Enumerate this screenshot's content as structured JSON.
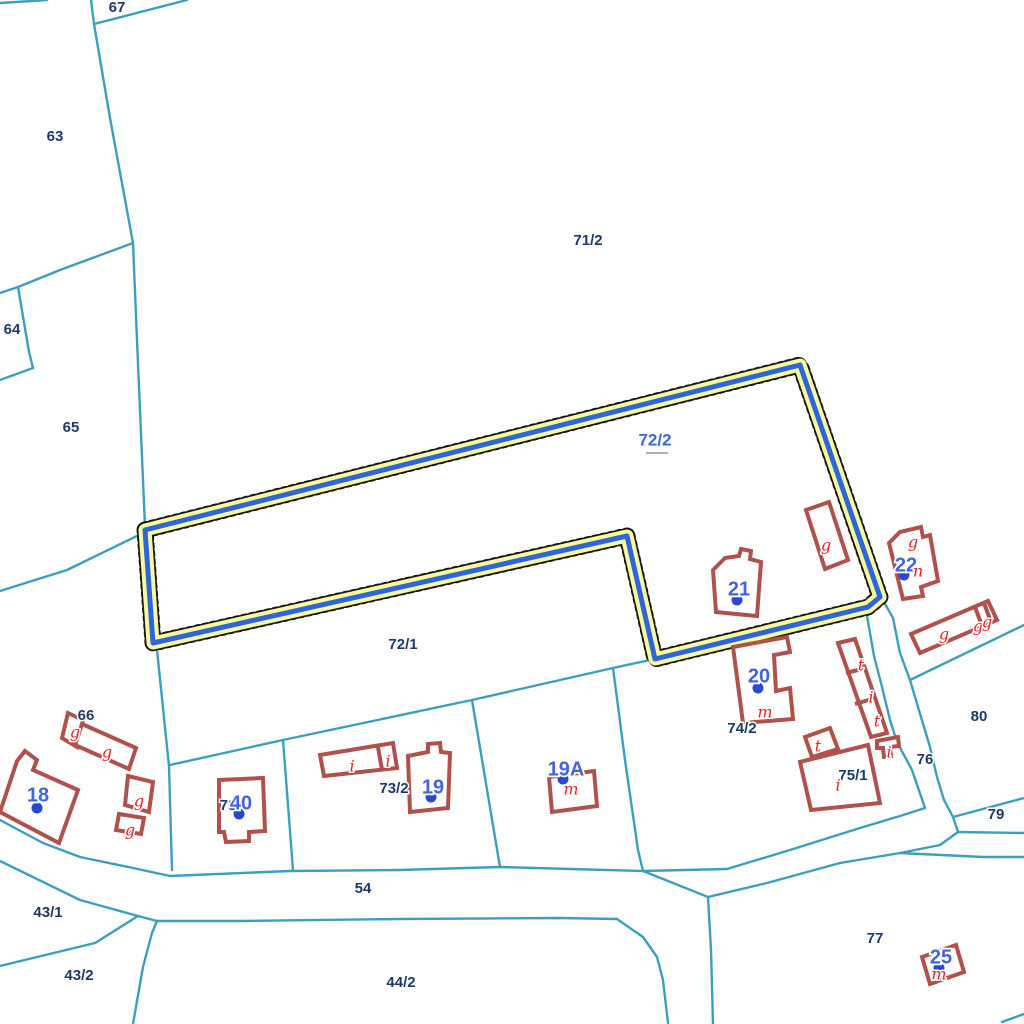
{
  "map": {
    "title": "cadastral-parcel-map",
    "selected_parcel": "72/2",
    "colors": {
      "boundary": "#3C9FC0",
      "parcel_label": "#1D3A6C",
      "selected_label": "#3B6AD9",
      "house_number": "#4463E4",
      "house_dot": "#2B49D0",
      "building_stroke": "#B0524B",
      "use_label": "#E4252B",
      "highlight_halo": "#F8F8A0",
      "highlight_stroke": "#2D65DB",
      "highlight_dots": "#161616",
      "background": "#FFFFFF"
    }
  },
  "boundaries": [
    {
      "points": [
        [
          0,
          3
        ],
        [
          47,
          0
        ]
      ]
    },
    {
      "points": [
        [
          91,
          0
        ],
        [
          94,
          24
        ],
        [
          110,
          118
        ],
        [
          133,
          243
        ],
        [
          137,
          340
        ],
        [
          145,
          527
        ]
      ]
    },
    {
      "points": [
        [
          94,
          24
        ],
        [
          187,
          0
        ]
      ]
    },
    {
      "points": [
        [
          133,
          243
        ],
        [
          60,
          270
        ],
        [
          18,
          287
        ],
        [
          0,
          293
        ]
      ]
    },
    {
      "points": [
        [
          18,
          287
        ],
        [
          29,
          352
        ],
        [
          33,
          368
        ]
      ]
    },
    {
      "points": [
        [
          33,
          368
        ],
        [
          0,
          380
        ]
      ]
    },
    {
      "points": [
        [
          0,
          591
        ],
        [
          67,
          570
        ],
        [
          143,
          533
        ]
      ]
    },
    {
      "points": [
        [
          145,
          529
        ],
        [
          157,
          650
        ],
        [
          169,
          766
        ],
        [
          172,
          870
        ]
      ]
    },
    {
      "points": [
        [
          170,
          765
        ],
        [
          283,
          740
        ],
        [
          472,
          700
        ],
        [
          613,
          668
        ],
        [
          650,
          660
        ]
      ]
    },
    {
      "points": [
        [
          283,
          740
        ],
        [
          293,
          870
        ]
      ]
    },
    {
      "points": [
        [
          472,
          700
        ],
        [
          500,
          867
        ]
      ]
    },
    {
      "points": [
        [
          613,
          668
        ],
        [
          625,
          760
        ],
        [
          638,
          850
        ],
        [
          643,
          871
        ]
      ]
    },
    {
      "points": [
        [
          0,
          820
        ],
        [
          43,
          843
        ],
        [
          80,
          857
        ],
        [
          133,
          868
        ],
        [
          170,
          876
        ],
        [
          290,
          871
        ],
        [
          400,
          870
        ],
        [
          500,
          867
        ],
        [
          570,
          869
        ],
        [
          643,
          871
        ],
        [
          727,
          869
        ]
      ]
    },
    {
      "points": [
        [
          727,
          869
        ],
        [
          790,
          850
        ],
        [
          860,
          828
        ],
        [
          900,
          816
        ],
        [
          925,
          808
        ]
      ]
    },
    {
      "points": [
        [
          866,
          610
        ],
        [
          874,
          656
        ],
        [
          882,
          687
        ],
        [
          890,
          720
        ],
        [
          897,
          742
        ],
        [
          912,
          770
        ],
        [
          925,
          808
        ]
      ]
    },
    {
      "points": [
        [
          884,
          602
        ],
        [
          893,
          618
        ],
        [
          900,
          653
        ],
        [
          910,
          680
        ],
        [
          918,
          707
        ],
        [
          930,
          747
        ],
        [
          937,
          777
        ],
        [
          944,
          800
        ],
        [
          953,
          817
        ]
      ]
    },
    {
      "points": [
        [
          910,
          680
        ],
        [
          1024,
          625
        ]
      ]
    },
    {
      "points": [
        [
          953,
          817
        ],
        [
          1024,
          798
        ]
      ]
    },
    {
      "points": [
        [
          953,
          817
        ],
        [
          958,
          832
        ],
        [
          1024,
          833
        ]
      ]
    },
    {
      "points": [
        [
          708,
          897
        ],
        [
          767,
          883
        ],
        [
          840,
          863
        ],
        [
          900,
          853
        ],
        [
          940,
          845
        ],
        [
          958,
          832
        ]
      ]
    },
    {
      "points": [
        [
          0,
          861
        ],
        [
          80,
          900
        ],
        [
          138,
          916
        ],
        [
          157,
          921
        ],
        [
          243,
          921
        ],
        [
          400,
          919
        ],
        [
          560,
          918
        ],
        [
          617,
          919
        ]
      ]
    },
    {
      "points": [
        [
          617,
          919
        ],
        [
          643,
          937
        ],
        [
          657,
          957
        ],
        [
          663,
          980
        ],
        [
          668,
          1023
        ]
      ]
    },
    {
      "points": [
        [
          643,
          871
        ],
        [
          708,
          897
        ]
      ]
    },
    {
      "points": [
        [
          708,
          897
        ],
        [
          711,
          950
        ],
        [
          713,
          1024
        ]
      ]
    },
    {
      "points": [
        [
          138,
          916
        ],
        [
          95,
          943
        ],
        [
          0,
          966
        ]
      ]
    },
    {
      "points": [
        [
          157,
          921
        ],
        [
          152,
          933
        ],
        [
          143,
          967
        ],
        [
          133,
          1024
        ]
      ]
    },
    {
      "points": [
        [
          900,
          853
        ],
        [
          983,
          857
        ],
        [
          1024,
          857
        ]
      ]
    },
    {
      "points": [
        [
          1002,
          1022
        ],
        [
          1024,
          1014
        ]
      ]
    }
  ],
  "highlight": {
    "parcel": "72/2",
    "points": [
      [
        145,
        530
      ],
      [
        800,
        365
      ],
      [
        880,
        597
      ],
      [
        868,
        607
      ],
      [
        655,
        659
      ],
      [
        627,
        536
      ],
      [
        153,
        643
      ]
    ],
    "label": {
      "text": "72/2",
      "x": 655,
      "y": 441
    },
    "underline": [
      [
        646,
        453
      ],
      [
        668,
        453
      ]
    ]
  },
  "buildings": [
    {
      "points": [
        [
          17,
          761
        ],
        [
          25,
          751
        ],
        [
          37,
          760
        ],
        [
          33,
          770
        ],
        [
          78,
          790
        ],
        [
          59,
          843
        ],
        [
          0,
          812
        ]
      ]
    },
    {
      "points": [
        [
          68,
          713
        ],
        [
          83,
          720
        ],
        [
          77,
          747
        ],
        [
          62,
          738
        ]
      ]
    },
    {
      "points": [
        [
          82,
          724
        ],
        [
          136,
          748
        ],
        [
          129,
          769
        ],
        [
          75,
          745
        ]
      ]
    },
    {
      "points": [
        [
          128,
          776
        ],
        [
          153,
          782
        ],
        [
          149,
          812
        ],
        [
          125,
          805
        ]
      ]
    },
    {
      "points": [
        [
          119,
          814
        ],
        [
          144,
          818
        ],
        [
          141,
          834
        ],
        [
          116,
          830
        ]
      ]
    },
    {
      "points": [
        [
          219,
          780
        ],
        [
          263,
          778
        ],
        [
          265,
          831
        ],
        [
          249,
          832
        ],
        [
          249,
          841
        ],
        [
          226,
          842
        ],
        [
          224,
          832
        ],
        [
          219,
          832
        ]
      ]
    },
    {
      "points": [
        [
          320,
          755
        ],
        [
          393,
          743
        ],
        [
          397,
          768
        ],
        [
          324,
          776
        ]
      ]
    },
    {
      "points": [
        [
          408,
          756
        ],
        [
          428,
          752
        ],
        [
          428,
          744
        ],
        [
          440,
          743
        ],
        [
          441,
          752
        ],
        [
          450,
          753
        ],
        [
          448,
          808
        ],
        [
          410,
          812
        ]
      ]
    },
    {
      "points": [
        [
          549,
          777
        ],
        [
          594,
          771
        ],
        [
          597,
          806
        ],
        [
          552,
          812
        ]
      ]
    },
    {
      "points": [
        [
          733,
          647
        ],
        [
          787,
          637
        ],
        [
          790,
          652
        ],
        [
          774,
          655
        ],
        [
          776,
          691
        ],
        [
          790,
          688
        ],
        [
          793,
          719
        ],
        [
          743,
          723
        ]
      ]
    },
    {
      "points": [
        [
          713,
          570
        ],
        [
          725,
          558
        ],
        [
          739,
          556
        ],
        [
          741,
          549
        ],
        [
          751,
          551
        ],
        [
          750,
          559
        ],
        [
          761,
          562
        ],
        [
          757,
          616
        ],
        [
          716,
          612
        ]
      ]
    },
    {
      "points": [
        [
          806,
          510
        ],
        [
          829,
          502
        ],
        [
          848,
          560
        ],
        [
          825,
          569
        ]
      ]
    },
    {
      "points": [
        [
          889,
          543
        ],
        [
          900,
          532
        ],
        [
          921,
          527
        ],
        [
          923,
          537
        ],
        [
          930,
          535
        ],
        [
          938,
          581
        ],
        [
          921,
          587
        ],
        [
          923,
          596
        ],
        [
          903,
          599
        ]
      ]
    },
    {
      "points": [
        [
          911,
          634
        ],
        [
          988,
          601
        ],
        [
          997,
          620
        ],
        [
          920,
          653
        ]
      ]
    },
    {
      "points": [
        [
          838,
          643
        ],
        [
          855,
          639
        ],
        [
          887,
          733
        ],
        [
          871,
          737
        ]
      ]
    },
    {
      "points": [
        [
          805,
          737
        ],
        [
          830,
          728
        ],
        [
          838,
          749
        ],
        [
          812,
          757
        ]
      ]
    },
    {
      "points": [
        [
          800,
          762
        ],
        [
          868,
          745
        ],
        [
          880,
          803
        ],
        [
          811,
          810
        ]
      ]
    },
    {
      "points": [
        [
          877,
          741
        ],
        [
          898,
          737
        ],
        [
          899,
          746
        ],
        [
          890,
          747
        ],
        [
          891,
          756
        ],
        [
          884,
          757
        ],
        [
          883,
          748
        ],
        [
          877,
          748
        ]
      ]
    },
    {
      "points": [
        [
          922,
          957
        ],
        [
          956,
          945
        ],
        [
          964,
          972
        ],
        [
          930,
          984
        ]
      ]
    }
  ],
  "building_dividers": [
    {
      "points": [
        [
          378,
          747
        ],
        [
          382,
          770
        ]
      ]
    },
    {
      "points": [
        [
          975,
          607
        ],
        [
          982,
          626
        ]
      ]
    },
    {
      "points": [
        [
          984,
          603
        ],
        [
          991,
          622
        ]
      ]
    },
    {
      "points": [
        [
          846,
          673
        ],
        [
          862,
          669
        ]
      ]
    },
    {
      "points": [
        [
          855,
          704
        ],
        [
          872,
          699
        ]
      ]
    }
  ],
  "parcel_labels": [
    {
      "text": "67",
      "x": 117,
      "y": 8
    },
    {
      "text": "63",
      "x": 55,
      "y": 137
    },
    {
      "text": "64",
      "x": 12,
      "y": 330
    },
    {
      "text": "65",
      "x": 71,
      "y": 428
    },
    {
      "text": "71/2",
      "x": 588,
      "y": 241
    },
    {
      "text": "72/1",
      "x": 403,
      "y": 645
    },
    {
      "text": "66",
      "x": 86,
      "y": 716
    },
    {
      "text": "73",
      "x": 228,
      "y": 806
    },
    {
      "text": "73/2",
      "x": 394,
      "y": 789
    },
    {
      "text": "74/2",
      "x": 742,
      "y": 729
    },
    {
      "text": "75/1",
      "x": 853,
      "y": 776
    },
    {
      "text": "76",
      "x": 925,
      "y": 760
    },
    {
      "text": "80",
      "x": 979,
      "y": 717
    },
    {
      "text": "79",
      "x": 996,
      "y": 815
    },
    {
      "text": "77",
      "x": 875,
      "y": 939
    },
    {
      "text": "54",
      "x": 363,
      "y": 889
    },
    {
      "text": "43/1",
      "x": 48,
      "y": 913
    },
    {
      "text": "43/2",
      "x": 79,
      "y": 976
    },
    {
      "text": "44/2",
      "x": 401,
      "y": 983
    }
  ],
  "house_numbers": [
    {
      "text": "18",
      "x": 38,
      "y": 796,
      "dot": [
        37,
        808
      ]
    },
    {
      "text": "40",
      "x": 241,
      "y": 804,
      "dot": [
        239,
        814
      ]
    },
    {
      "text": "19",
      "x": 433,
      "y": 788,
      "dot": [
        431,
        797
      ]
    },
    {
      "text": "19A",
      "x": 566,
      "y": 770,
      "dot": [
        563,
        779
      ]
    },
    {
      "text": "20",
      "x": 759,
      "y": 677,
      "dot": [
        758,
        688
      ]
    },
    {
      "text": "21",
      "x": 739,
      "y": 590,
      "dot": [
        737,
        600
      ]
    },
    {
      "text": "22",
      "x": 906,
      "y": 566,
      "dot": [
        904,
        575
      ]
    },
    {
      "text": "25",
      "x": 941,
      "y": 958,
      "dot": [
        939,
        968
      ]
    }
  ],
  "use_labels": [
    {
      "text": "g",
      "x": 75,
      "y": 733
    },
    {
      "text": "g",
      "x": 107,
      "y": 753
    },
    {
      "text": "g",
      "x": 139,
      "y": 802
    },
    {
      "text": "g",
      "x": 130,
      "y": 831
    },
    {
      "text": "i",
      "x": 352,
      "y": 767
    },
    {
      "text": "i",
      "x": 388,
      "y": 762
    },
    {
      "text": "m",
      "x": 571,
      "y": 790
    },
    {
      "text": "m",
      "x": 765,
      "y": 713
    },
    {
      "text": "g",
      "x": 826,
      "y": 546
    },
    {
      "text": "g",
      "x": 913,
      "y": 543
    },
    {
      "text": "n",
      "x": 918,
      "y": 572
    },
    {
      "text": "g",
      "x": 944,
      "y": 635
    },
    {
      "text": "g",
      "x": 978,
      "y": 627
    },
    {
      "text": "g",
      "x": 987,
      "y": 623
    },
    {
      "text": "t",
      "x": 861,
      "y": 666
    },
    {
      "text": "i",
      "x": 871,
      "y": 698
    },
    {
      "text": "t",
      "x": 877,
      "y": 722
    },
    {
      "text": "t",
      "x": 818,
      "y": 747
    },
    {
      "text": "i",
      "x": 838,
      "y": 786
    },
    {
      "text": "i",
      "x": 889,
      "y": 753
    },
    {
      "text": "m",
      "x": 939,
      "y": 975
    }
  ]
}
